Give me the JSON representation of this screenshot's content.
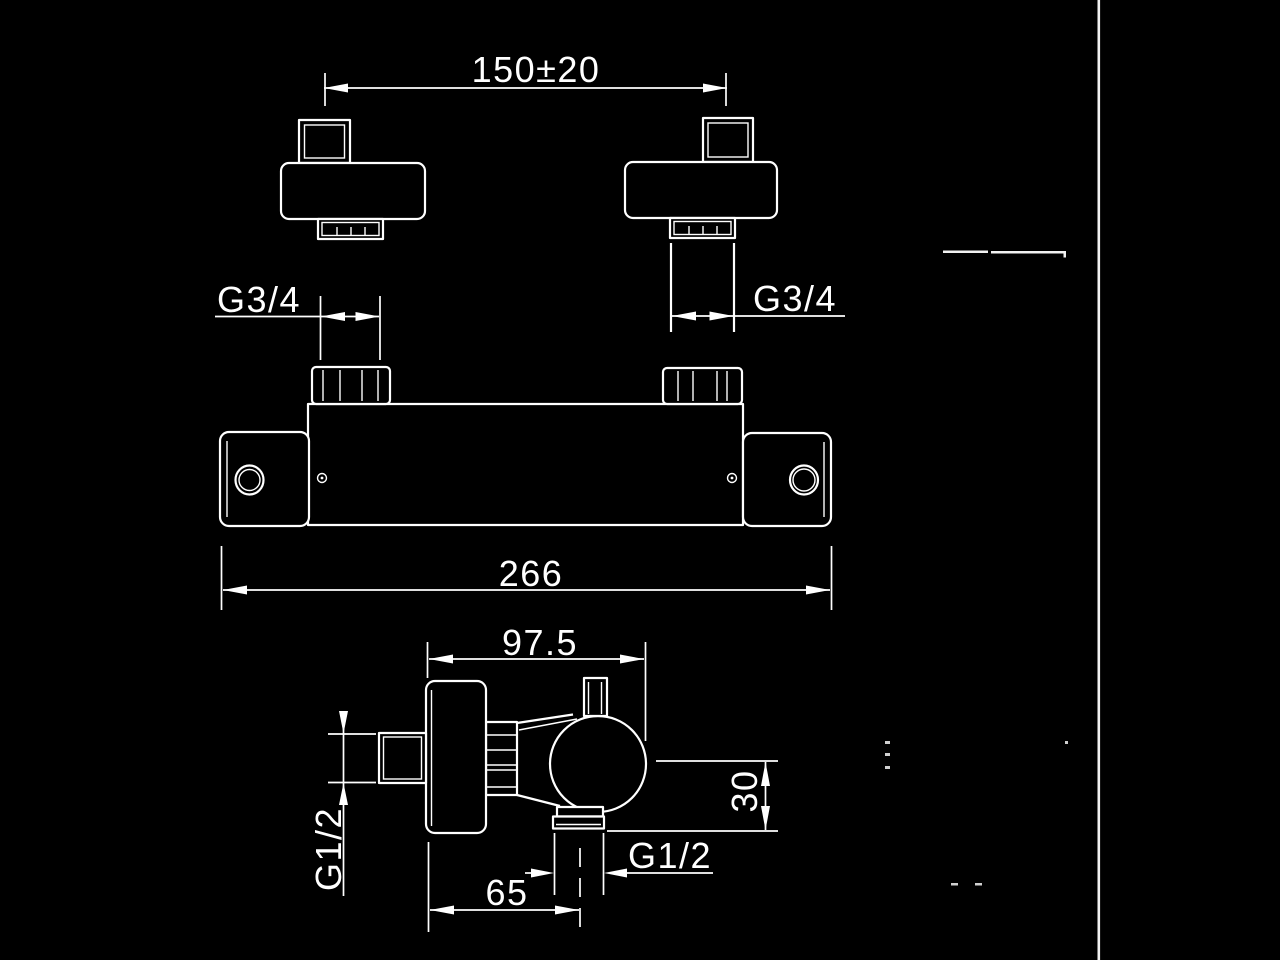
{
  "drawing": {
    "labels": {
      "wall_spacing": "150±20",
      "thread_left": "G3/4",
      "thread_right": "G3/4",
      "overall_width": "266",
      "depth": "97.5",
      "inlet_thread": "G1/2",
      "outlet_thread": "G1/2",
      "outlet_drop": "30",
      "outlet_offset": "65"
    },
    "colors": {
      "background": "#000000",
      "line": "#ffffff"
    }
  }
}
